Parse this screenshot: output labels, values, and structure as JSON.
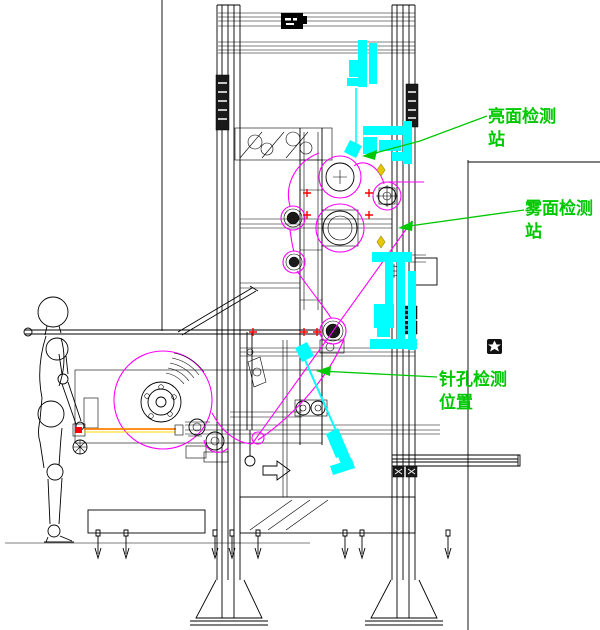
{
  "page": {
    "background": "#FFFFFF",
    "width": 600,
    "height": 630
  },
  "drawing": {
    "kind": "machine-side-view-cad-drawing",
    "labels": {
      "bright_station": {
        "line1": "亮面检测",
        "line2": "站"
      },
      "matte_station": {
        "line1": "雾面检测",
        "line2": "站"
      },
      "pinhole_position": {
        "line1": "针孔检测",
        "line2": "位置"
      }
    },
    "colors": {
      "annotation_green": "#00C800",
      "film_path_magenta": "#FF00FF",
      "highlight_cyan": "#00FFFF",
      "marker_red": "#FF0000",
      "marker_yellow": "#E6C800",
      "film_line_orange": "#FF8000",
      "film_line_yellow": "#FFD700",
      "structure_black": "#000000"
    }
  }
}
